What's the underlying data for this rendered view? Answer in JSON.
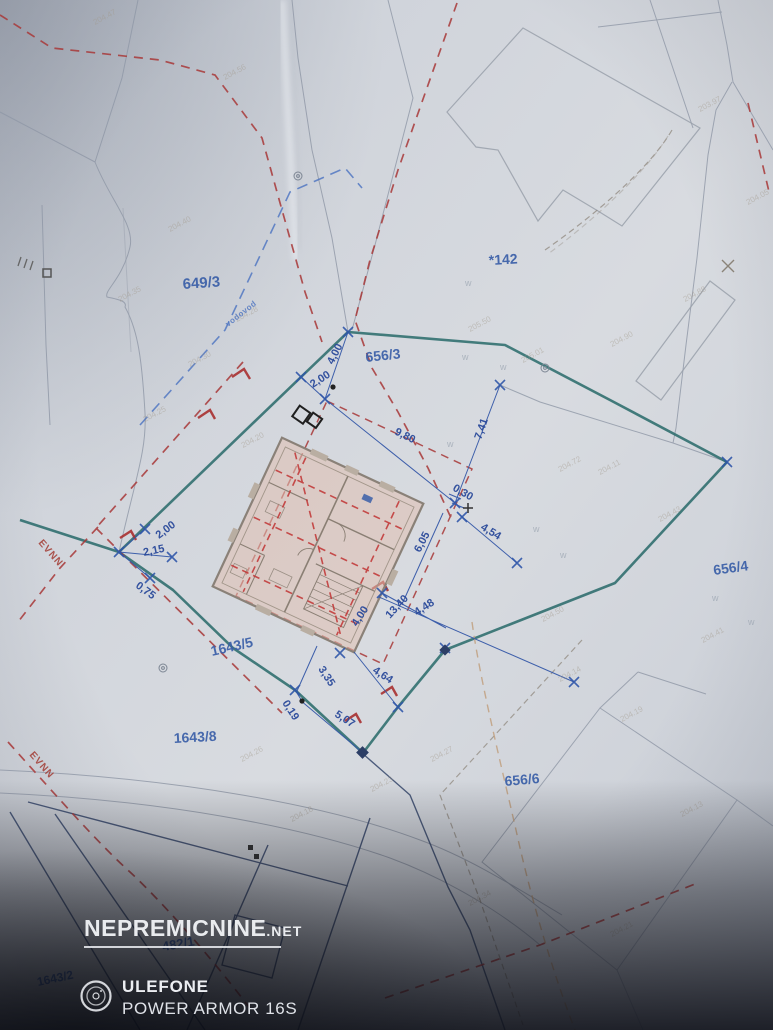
{
  "watermark": {
    "brand": "NEPREMICNINE",
    "tld": ".NET"
  },
  "device_overlay": {
    "brand": "ULEFONE",
    "model": "POWER ARMOR 16S",
    "icon": "camera-lens-icon"
  },
  "colors": {
    "parcel_blue": "#3a5fa8",
    "dimension_blue": "#2b4a9b",
    "survey_blue": "#3558a8",
    "boundary_teal": "#2d6d6d",
    "dashed_red": "#a83838",
    "dashed_tan": "#bf9c79",
    "building_fill": "#e0bfb0",
    "building_wall": "#8a7f74",
    "watermark_white": "#f2f4f7",
    "easement_red": "#a33c34",
    "utility_blue": "#4a72c0"
  },
  "map": {
    "parcel_labels": [
      {
        "t": "649/3",
        "x": 183,
        "y": 289,
        "r": -4,
        "s": 15
      },
      {
        "t": "*142",
        "x": 489,
        "y": 265,
        "r": -3,
        "s": 14
      },
      {
        "t": "656/3",
        "x": 366,
        "y": 362,
        "r": -6,
        "s": 14
      },
      {
        "t": "656/4",
        "x": 714,
        "y": 575,
        "r": -8,
        "s": 14
      },
      {
        "t": "656/6",
        "x": 505,
        "y": 786,
        "r": -5,
        "s": 14
      },
      {
        "t": "1643/5",
        "x": 212,
        "y": 656,
        "r": -13,
        "s": 14
      },
      {
        "t": "1643/8",
        "x": 174,
        "y": 743,
        "r": -3,
        "s": 14
      },
      {
        "t": "482/1",
        "x": 163,
        "y": 951,
        "r": -10,
        "s": 13,
        "c": "#5a7fc8"
      },
      {
        "t": "1643/2",
        "x": 38,
        "y": 986,
        "r": -12,
        "s": 12,
        "c": "#5a7fc8"
      }
    ],
    "dimension_labels": [
      {
        "t": "4,00",
        "x": 333,
        "y": 365,
        "r": -63
      },
      {
        "t": "2,00",
        "x": 313,
        "y": 388,
        "r": -33
      },
      {
        "t": "9,80",
        "x": 394,
        "y": 434,
        "r": 26
      },
      {
        "t": "7,41",
        "x": 481,
        "y": 440,
        "r": -71
      },
      {
        "t": "0,30",
        "x": 452,
        "y": 490,
        "r": 30
      },
      {
        "t": "4,54",
        "x": 480,
        "y": 529,
        "r": 31
      },
      {
        "t": "6,05",
        "x": 420,
        "y": 553,
        "r": -62
      },
      {
        "t": "4,00",
        "x": 357,
        "y": 627,
        "r": -57
      },
      {
        "t": "13,40",
        "x": 390,
        "y": 619,
        "r": -47
      },
      {
        "t": "4,48",
        "x": 417,
        "y": 616,
        "r": -33
      },
      {
        "t": "3,35",
        "x": 318,
        "y": 669,
        "r": 57
      },
      {
        "t": "4,64",
        "x": 372,
        "y": 672,
        "r": 33
      },
      {
        "t": "0,19",
        "x": 282,
        "y": 703,
        "r": 57
      },
      {
        "t": "5,07",
        "x": 334,
        "y": 716,
        "r": 33
      },
      {
        "t": "2,00",
        "x": 159,
        "y": 539,
        "r": -37
      },
      {
        "t": "2,15",
        "x": 144,
        "y": 556,
        "r": -12
      },
      {
        "t": "0,75",
        "x": 135,
        "y": 587,
        "r": 36
      }
    ],
    "easement_labels": [
      {
        "t": "EVNN",
        "x": 38,
        "y": 543,
        "r": 49
      },
      {
        "t": "EVNN",
        "x": 29,
        "y": 755,
        "r": 49
      }
    ],
    "utility_labels": [
      {
        "t": "vodovod",
        "x": 228,
        "y": 327,
        "r": -38
      }
    ],
    "spot_elevations": [
      {
        "t": "204.47",
        "x": 95,
        "y": 25,
        "r": -28
      },
      {
        "t": "204.56",
        "x": 225,
        "y": 80,
        "r": -28
      },
      {
        "t": "204.40",
        "x": 170,
        "y": 232,
        "r": -28
      },
      {
        "t": "204.35",
        "x": 120,
        "y": 302,
        "r": -28
      },
      {
        "t": "204.28",
        "x": 237,
        "y": 322,
        "r": -28
      },
      {
        "t": "204.30",
        "x": 190,
        "y": 367,
        "r": -28
      },
      {
        "t": "204.25",
        "x": 145,
        "y": 422,
        "r": -28
      },
      {
        "t": "204.20",
        "x": 243,
        "y": 448,
        "r": -28
      },
      {
        "t": "205.50",
        "x": 470,
        "y": 332,
        "r": -28
      },
      {
        "t": "205.01",
        "x": 523,
        "y": 363,
        "r": -28
      },
      {
        "t": "204.90",
        "x": 612,
        "y": 347,
        "r": -28
      },
      {
        "t": "204.88",
        "x": 685,
        "y": 302,
        "r": -28
      },
      {
        "t": "203.97",
        "x": 700,
        "y": 112,
        "r": -28
      },
      {
        "t": "204.05",
        "x": 748,
        "y": 205,
        "r": -28
      },
      {
        "t": "204.72",
        "x": 560,
        "y": 472,
        "r": -28
      },
      {
        "t": "204.43",
        "x": 660,
        "y": 522,
        "r": -28
      },
      {
        "t": "204.41",
        "x": 703,
        "y": 643,
        "r": -28
      },
      {
        "t": "204.19",
        "x": 622,
        "y": 722,
        "r": -28
      },
      {
        "t": "204.14",
        "x": 560,
        "y": 682,
        "r": -28
      },
      {
        "t": "204.27",
        "x": 432,
        "y": 762,
        "r": -28
      },
      {
        "t": "204.23",
        "x": 372,
        "y": 792,
        "r": -28
      },
      {
        "t": "204.34",
        "x": 470,
        "y": 906,
        "r": -28
      },
      {
        "t": "204.21",
        "x": 612,
        "y": 937,
        "r": -28
      },
      {
        "t": "204.13",
        "x": 682,
        "y": 817,
        "r": -28
      },
      {
        "t": "204.26",
        "x": 242,
        "y": 762,
        "r": -28
      },
      {
        "t": "204.18",
        "x": 292,
        "y": 822,
        "r": -28
      },
      {
        "t": "204.50",
        "x": 543,
        "y": 622,
        "r": -28
      },
      {
        "t": "204.11",
        "x": 600,
        "y": 475,
        "r": -28
      }
    ],
    "boundary_marks": [
      {
        "t": "w",
        "x": 462,
        "y": 360
      },
      {
        "t": "w",
        "x": 500,
        "y": 370
      },
      {
        "t": "w",
        "x": 447,
        "y": 447
      },
      {
        "t": "w",
        "x": 533,
        "y": 532
      },
      {
        "t": "w",
        "x": 560,
        "y": 558
      },
      {
        "t": "w",
        "x": 712,
        "y": 601
      },
      {
        "t": "w",
        "x": 748,
        "y": 625
      },
      {
        "t": "w",
        "x": 465,
        "y": 286
      }
    ]
  }
}
